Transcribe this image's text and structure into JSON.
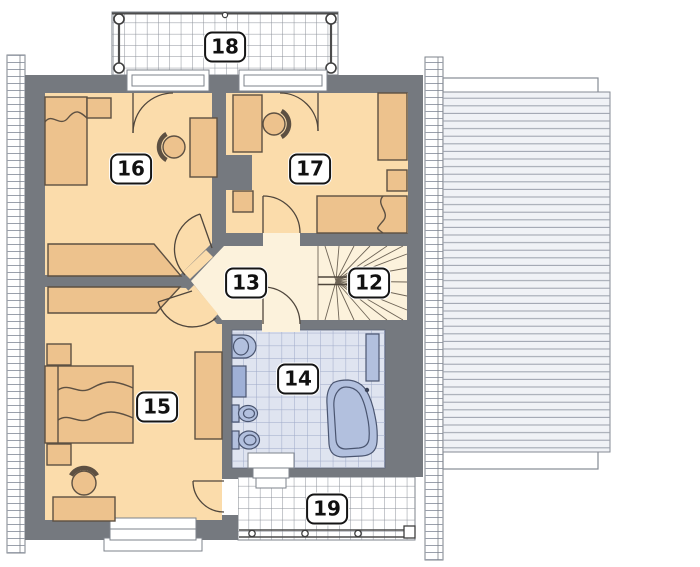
{
  "plan": {
    "labels": [
      {
        "id": "18",
        "text": "18"
      },
      {
        "id": "16",
        "text": "16"
      },
      {
        "id": "17",
        "text": "17"
      },
      {
        "id": "13",
        "text": "13"
      },
      {
        "id": "12",
        "text": "12"
      },
      {
        "id": "14",
        "text": "14"
      },
      {
        "id": "15",
        "text": "15"
      },
      {
        "id": "19",
        "text": "19"
      }
    ],
    "colors": {
      "wall": "#75797f",
      "room_floor": "#fbdcab",
      "hall_floor": "#fcf2dc",
      "furniture": "#edc28d",
      "furniture_outline": "#5d5042",
      "bath_tile": "#dfe4f0",
      "bath_tile_line": "#9da9c7",
      "bath_fixture": "#b2c0de",
      "bath_fixture_outline": "#4a5570",
      "roof_fill": "#f0f2f6",
      "roof_line": "#9aa0ab",
      "grid_line": "#8b9099",
      "outline": "#7e838b",
      "label_border": "#151515"
    }
  }
}
